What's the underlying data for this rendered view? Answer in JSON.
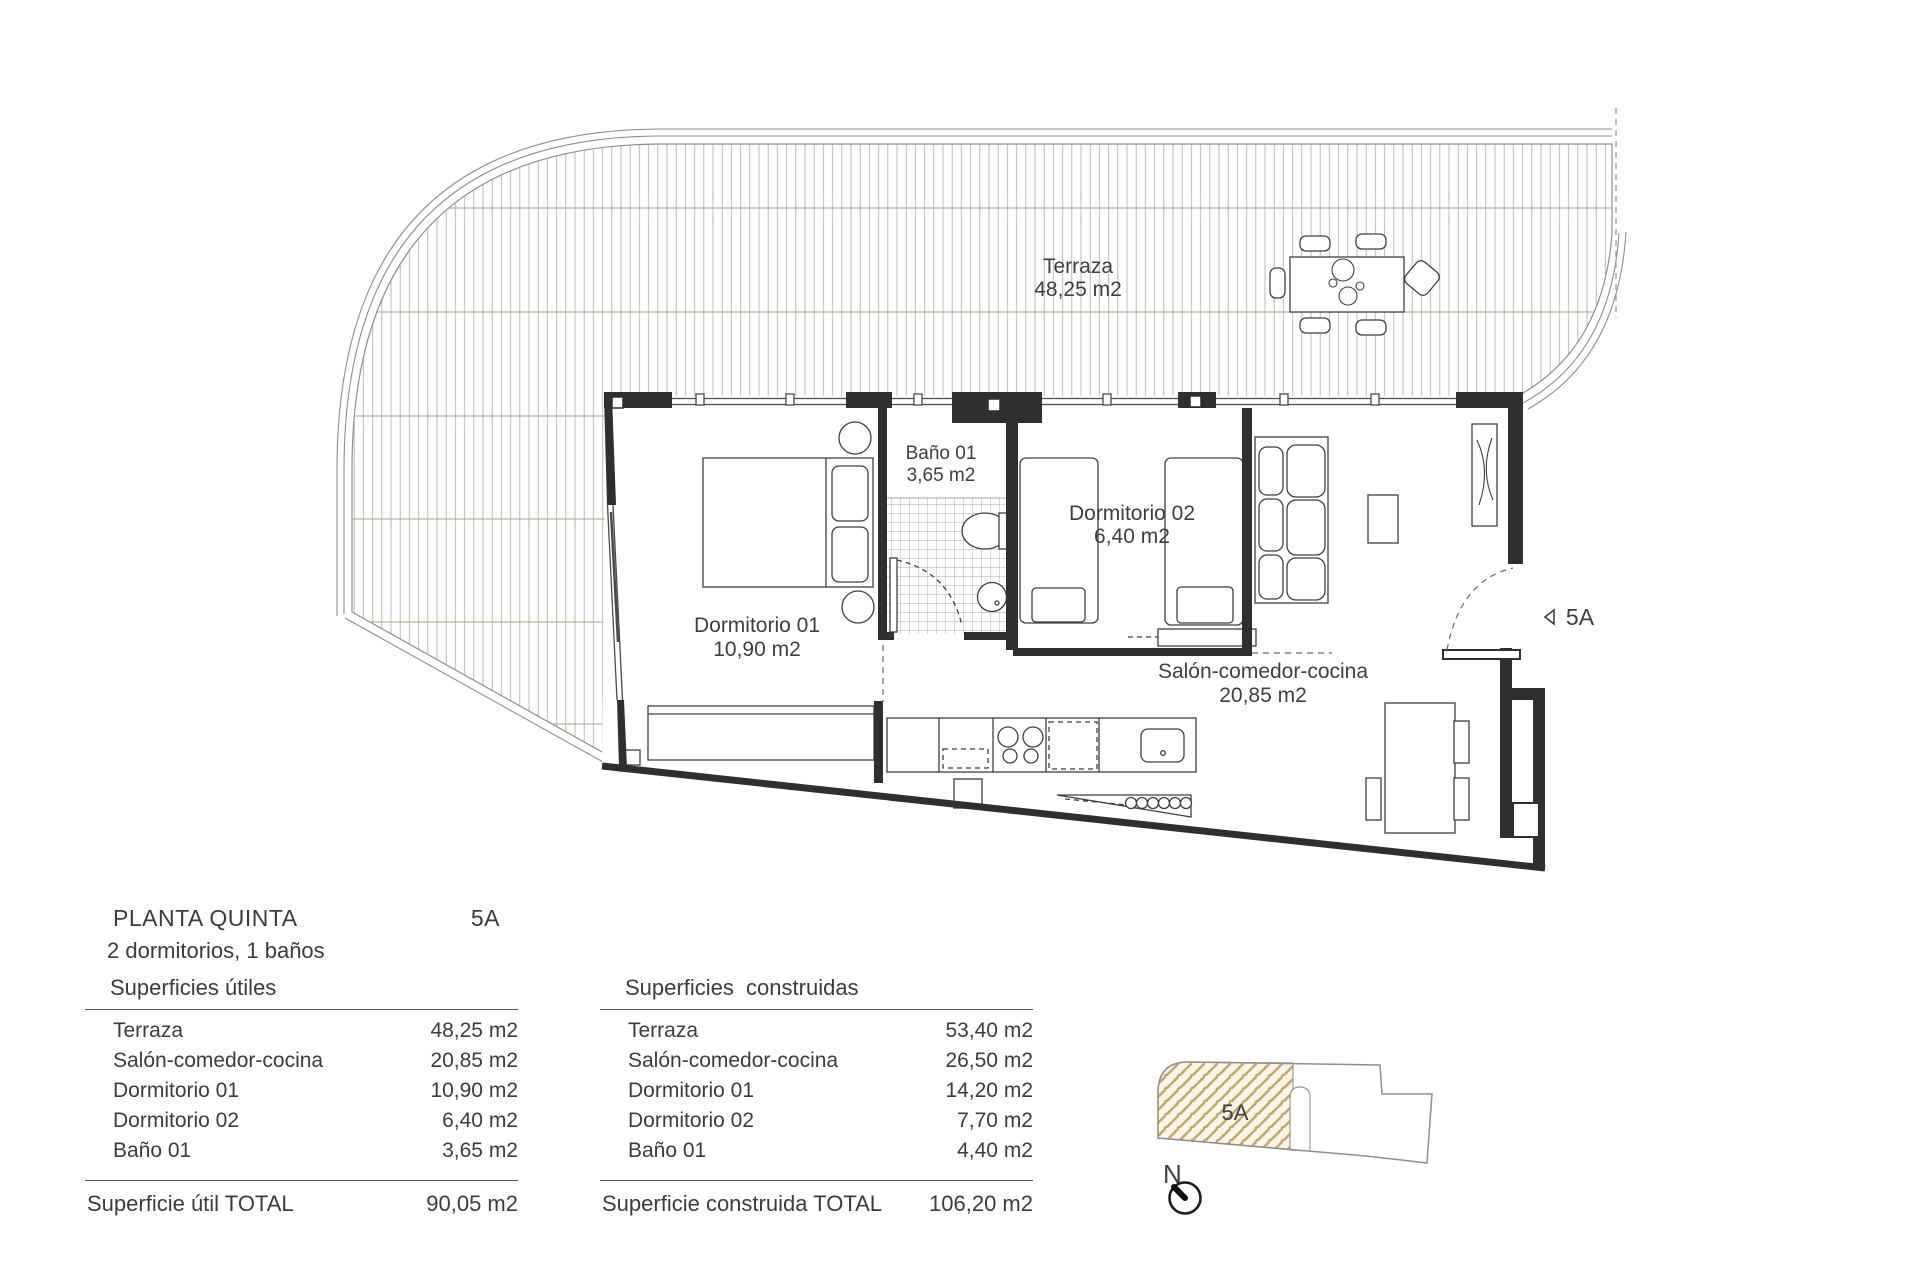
{
  "plan": {
    "terrace": {
      "name": "Terraza",
      "area": "48,25 m2"
    },
    "bano": {
      "name": "Baño 01",
      "area": "3,65 m2"
    },
    "dorm02": {
      "name": "Dormitorio 02",
      "area": "6,40 m2"
    },
    "dorm01": {
      "name": "Dormitorio 01",
      "area": "10,90 m2"
    },
    "salon": {
      "name": "Salón-comedor-cocina",
      "area": "20,85 m2"
    },
    "entry": {
      "label": "5A"
    }
  },
  "info": {
    "title": "PLANTA QUINTA",
    "unit": "5A",
    "subtitle": "2 dormitorios, 1 baños"
  },
  "tables": {
    "utiles": {
      "header": "Superficies útiles",
      "rows": [
        {
          "label": "Terraza",
          "value": "48,25 m2"
        },
        {
          "label": "Salón-comedor-cocina",
          "value": "20,85 m2"
        },
        {
          "label": "Dormitorio 01",
          "value": "10,90 m2"
        },
        {
          "label": "Dormitorio 02",
          "value": "6,40 m2"
        },
        {
          "label": "Baño 01",
          "value": "3,65 m2"
        }
      ],
      "total_label": "Superficie útil TOTAL",
      "total_value": "90,05 m2"
    },
    "construidas": {
      "header": "Superficies  construidas",
      "rows": [
        {
          "label": "Terraza",
          "value": "53,40 m2"
        },
        {
          "label": "Salón-comedor-cocina",
          "value": "26,50 m2"
        },
        {
          "label": "Dormitorio 01",
          "value": "14,20 m2"
        },
        {
          "label": "Dormitorio 02",
          "value": "7,70 m2"
        },
        {
          "label": "Baño 01",
          "value": "4,40 m2"
        }
      ],
      "total_label": "Superficie construida TOTAL",
      "total_value": "106,20 m2"
    }
  },
  "keyplan": {
    "unit_label": "5A",
    "north_label": "N"
  },
  "colors": {
    "wall": "#2f2f2f",
    "text": "#3f3f3f",
    "deck_line": "#b3b0a8",
    "deck_row_line": "#b5a383",
    "railing": "#8f8f8f",
    "keyplan_hatch": "#c8a566",
    "keyplan_bg": "#fbf5e8"
  }
}
